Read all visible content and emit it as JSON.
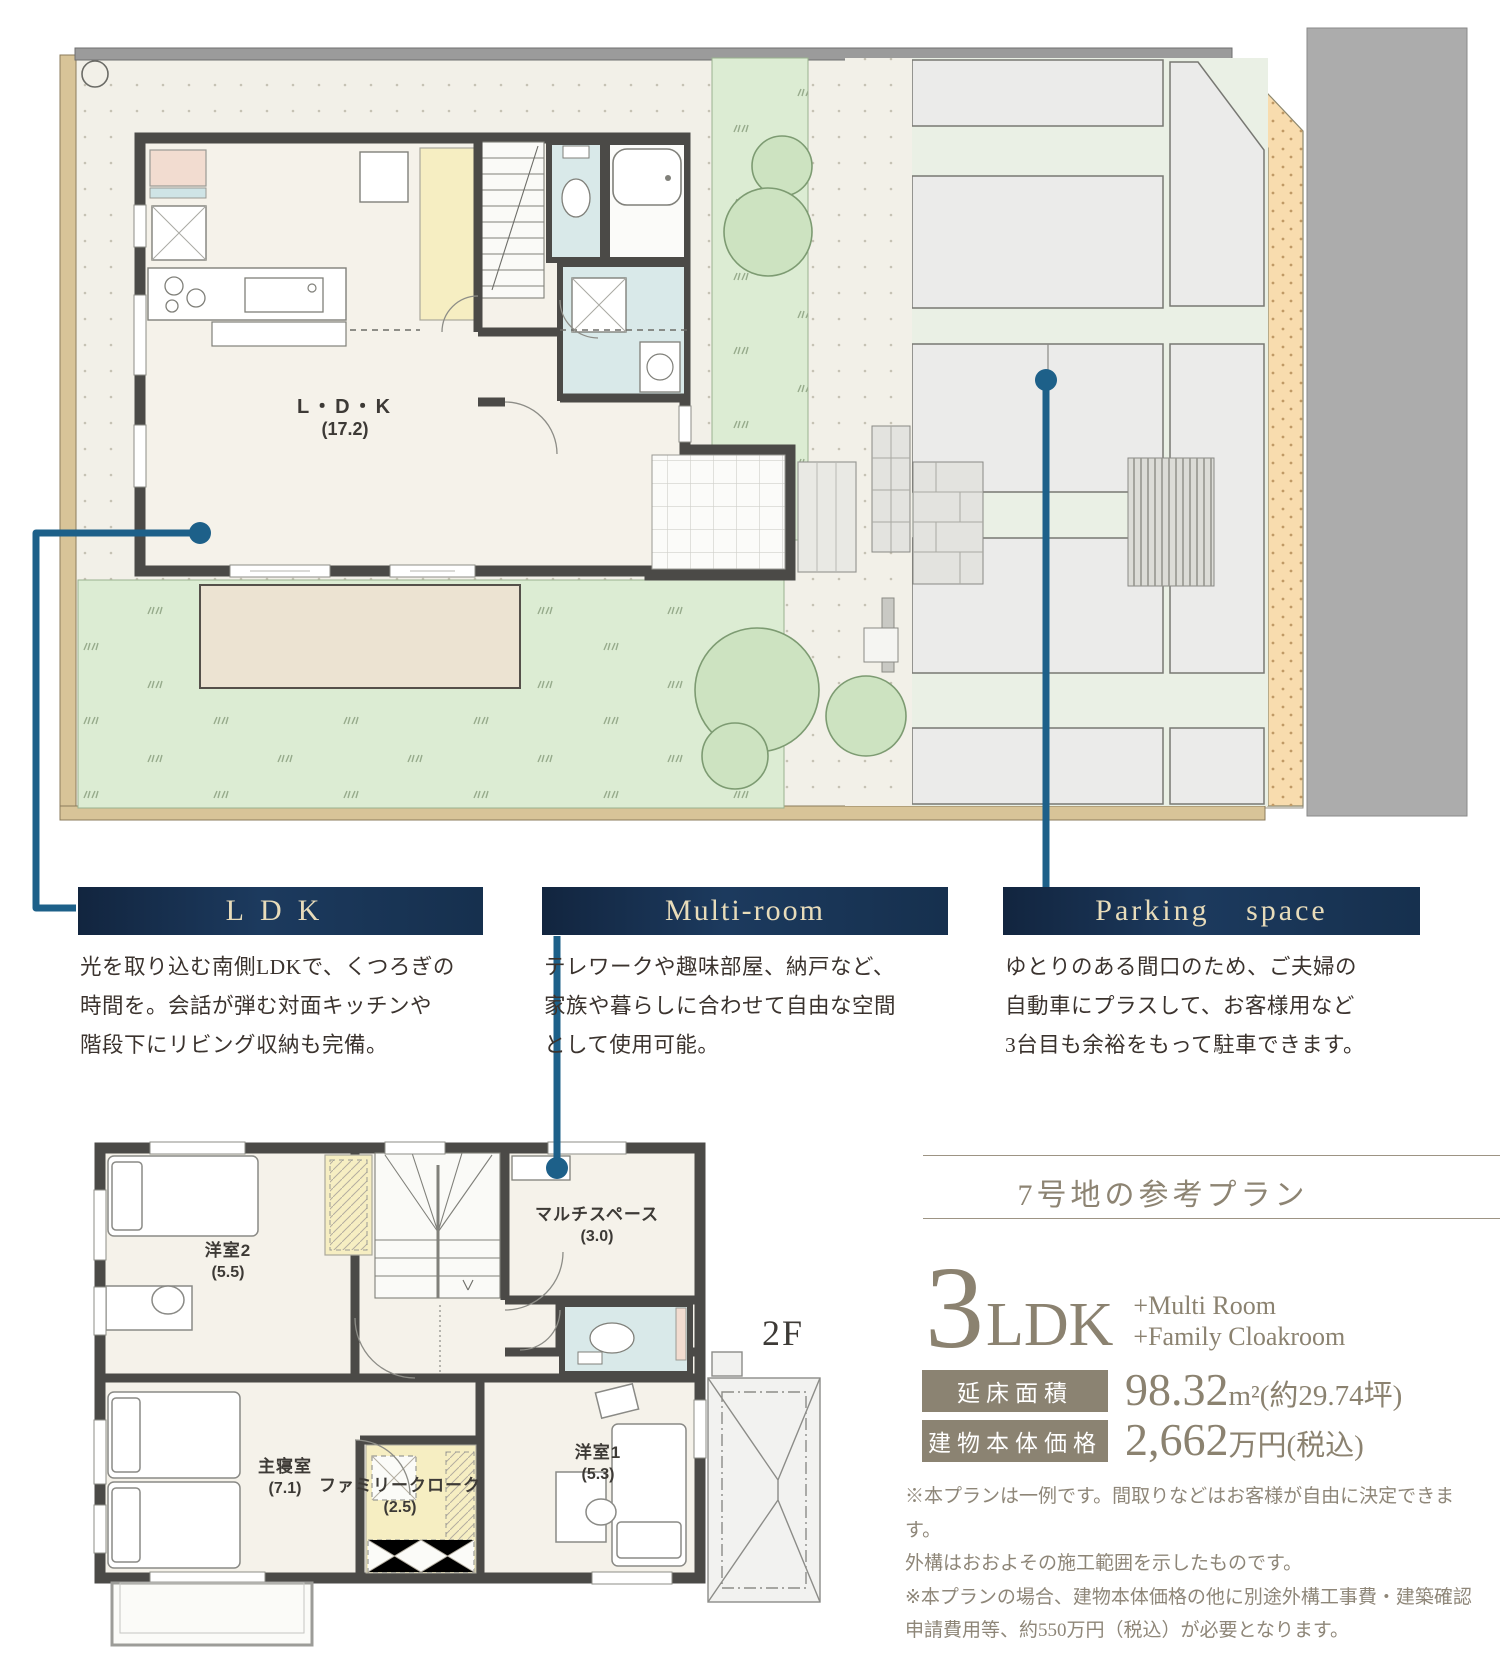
{
  "floor1": {
    "ldk_name": "L・D・K",
    "ldk_size": "(17.2)"
  },
  "floor2": {
    "floor_label": "2F",
    "rooms": [
      {
        "name": "洋室2",
        "size": "(5.5)"
      },
      {
        "name": "マルチスペース",
        "size": "(3.0)"
      },
      {
        "name": "主寝室",
        "size": "(7.1)"
      },
      {
        "name": "ファミリークローク",
        "size": "(2.5)"
      },
      {
        "name": "洋室1",
        "size": "(5.3)"
      }
    ]
  },
  "features": [
    {
      "title": "LDK",
      "body": "光を取り込む南側LDKで、くつろぎの\n時間を。会話が弾む対面キッチンや\n階段下にリビング収納も完備。"
    },
    {
      "title": "Multi-room",
      "body": "テレワークや趣味部屋、納戸など、\n家族や暮らしに合わせて自由な空間\nとして使用可能。"
    },
    {
      "title": "Parking space",
      "body": "ゆとりのある間口のため、ご夫婦の\n自動車にプラスして、お客様用など\n3台目も余裕をもって駐車できます。"
    }
  ],
  "plan_info": {
    "title": "7号地の参考プラン",
    "ldk_count": "3",
    "ldk_label": "LDK",
    "extra_1": "+Multi Room",
    "extra_2": "+Family Cloakroom",
    "area_label": "延床面積",
    "area_value": "98.32",
    "area_unit": "m²",
    "area_tsubo": "(約29.74坪)",
    "price_label": "建物本体価格",
    "price_value": "2,662",
    "price_unit": "万円(税込)",
    "notes": "※本プランは一例です。間取りなどはお客様が自由に決定できます。\n外構はおおよその施工範囲を示したものです。\n※本プランの場合、建物本体価格の他に別途外構工事費・建築確認\n申請費用等、約550万円（税込）が必要となります。"
  },
  "colors": {
    "accent_navy": "#16304e",
    "bar_text_cream": "#e8dcba",
    "connector_blue": "#1d6089",
    "taupe": "#8b8270",
    "wall_dark": "#4b4a47",
    "lawn_green": "#dcecd3",
    "sand_orange": "#f8dcae",
    "road_gray": "#acacac"
  }
}
